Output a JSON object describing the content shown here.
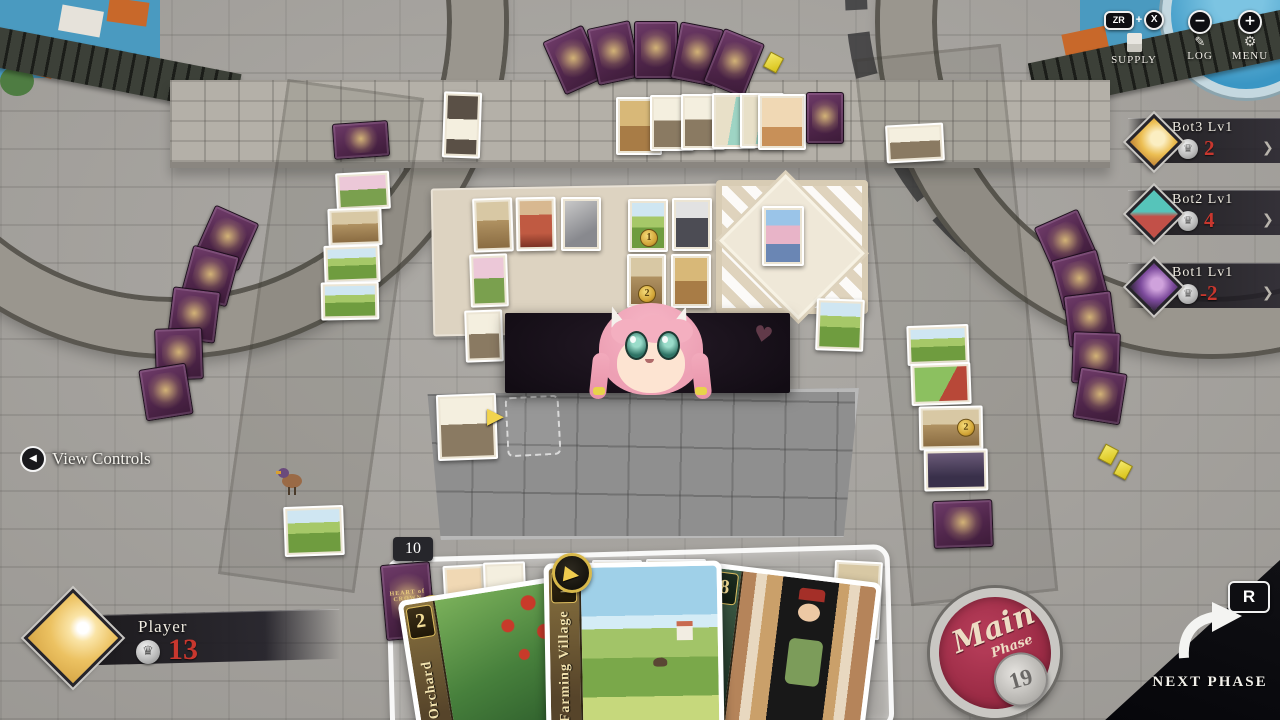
{
  "colors": {
    "score_red": "#c8372e",
    "gold_accent": "#e3c05a",
    "card_back_purple": "#5f2f58",
    "stamp_crimson": "#9c2c46"
  },
  "icons": {
    "chevron": "❯",
    "play": "▶",
    "back": "◀",
    "gear": "⚙",
    "minus": "−",
    "plus": "+",
    "crown": "♛",
    "heart": "♥",
    "pencil": "✎"
  },
  "hud": {
    "supply": {
      "zr": "ZR",
      "plus": "+",
      "x": "X",
      "label": "SUPPLY"
    },
    "log": {
      "label": "LOG"
    },
    "menu": {
      "label": "MENU"
    }
  },
  "view_controls": {
    "label": "View Controls"
  },
  "opponents": [
    {
      "name": "Bot3 Lv1",
      "score": "2"
    },
    {
      "name": "Bot2 Lv1",
      "score": "4"
    },
    {
      "name": "Bot1 Lv1",
      "score": "-2"
    }
  ],
  "player": {
    "name": "Player",
    "score": "13"
  },
  "phase_stamp": {
    "word1": "Main",
    "word2": "Phase",
    "turn": "19"
  },
  "next_phase": {
    "label": "NEXT PHASE",
    "button": "R"
  },
  "hand": {
    "deck_count": "10",
    "deck_title": "HEART of CROWN",
    "cards": [
      {
        "name": "Orchard",
        "cost": "2"
      },
      {
        "name": "Farming Village",
        "cost": "1"
      },
      {
        "name": "Duke",
        "cost": "8"
      }
    ]
  },
  "board": {
    "coins": {
      "market_top": "1",
      "market_mid": "2",
      "right_column": "2",
      "hand_right": "2"
    }
  }
}
